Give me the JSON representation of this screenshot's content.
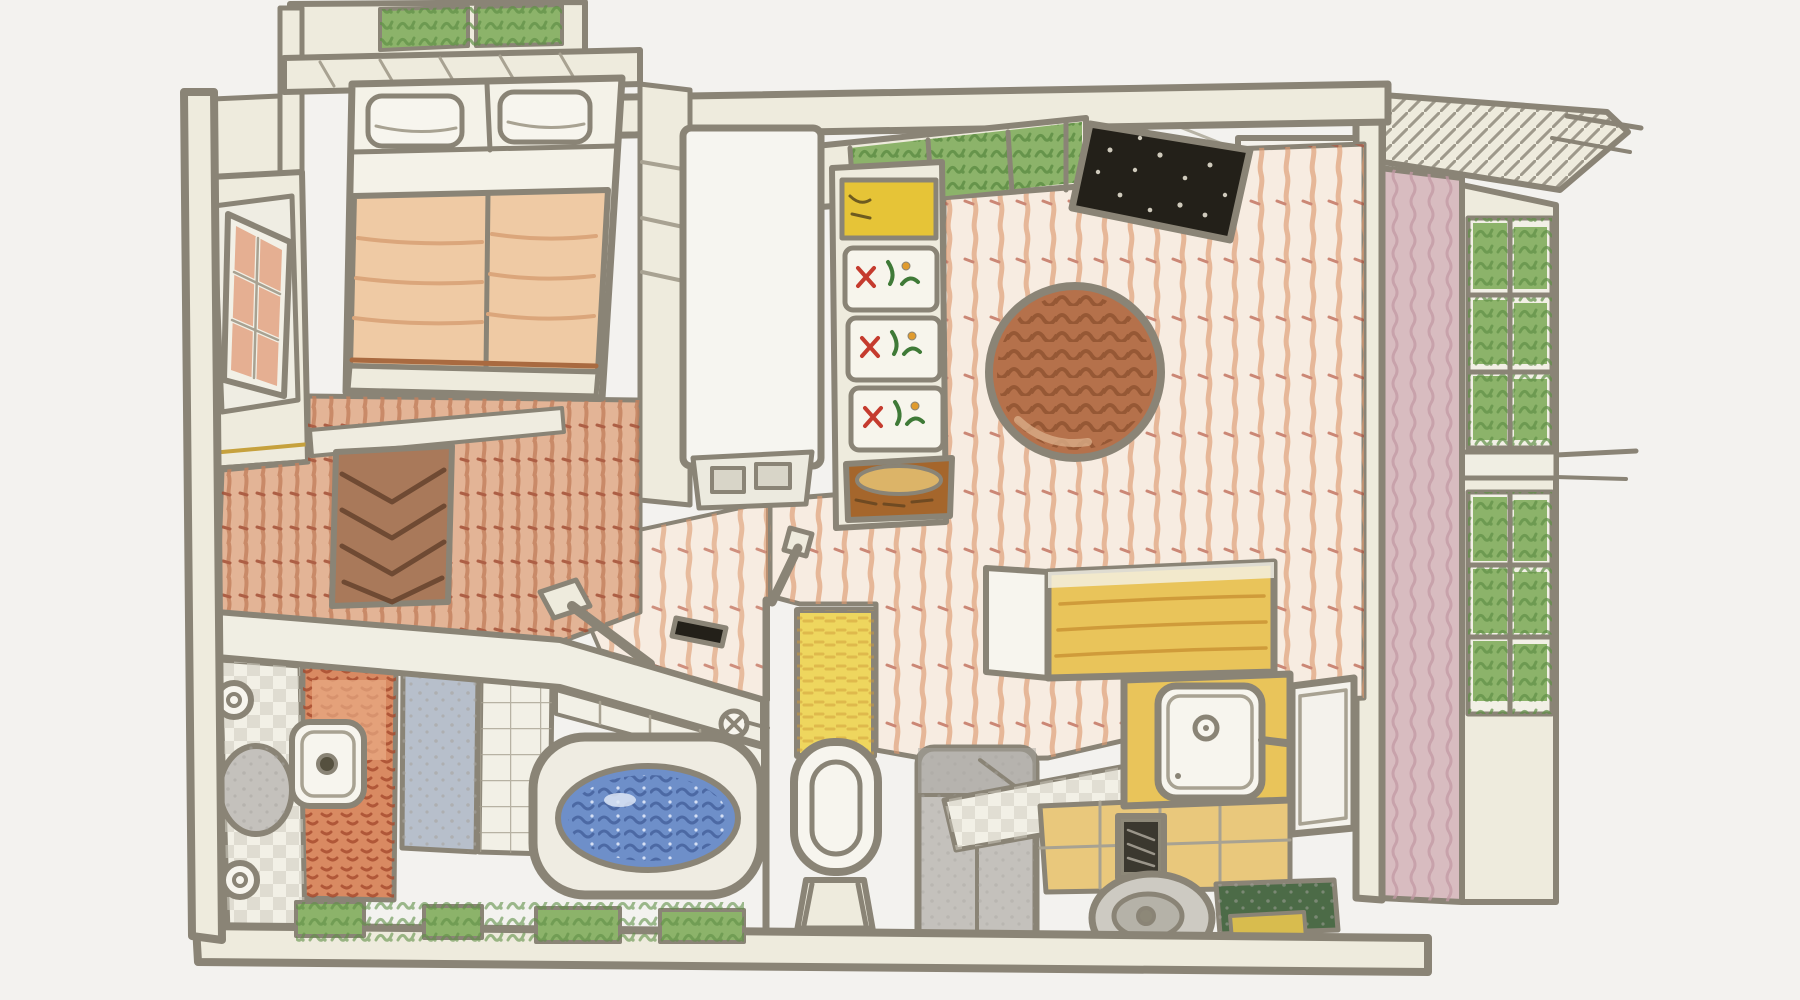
{
  "scene": {
    "type": "hand-drawn colored pencil sketch",
    "subject": "isometric cutaway floor plan of a small apartment",
    "rooms": [
      {
        "name": "bedroom",
        "objects": [
          "green-skylight",
          "headboard-shelf",
          "double-bed",
          "two-pillows",
          "peach-blanket",
          "open-window-peach-panes",
          "herringbone-dresser",
          "red-scribble-floor",
          "gold-trim-line"
        ]
      },
      {
        "name": "living-room",
        "objects": [
          "striped-pink-carpet",
          "round-brown-rug",
          "clerestory-green-windows",
          "black-speckled-panel",
          "flower-box-shelf",
          "yellow-storage-box",
          "woven-basket",
          "tall-white-cabinet-with-vent"
        ]
      },
      {
        "name": "bathroom",
        "objects": [
          "white-counter-ledge",
          "black-soap-dish",
          "shower-pipe",
          "bathtub",
          "blue-water",
          "faucet-knob",
          "terracotta-tile-wall",
          "blue-gray-wall",
          "white-tile-wall",
          "checkered-floor",
          "round-fixtures",
          "cistern-lid"
        ]
      },
      {
        "name": "toilet-nook",
        "objects": [
          "yellow-wall",
          "toilet",
          "step-stool",
          "diagonal-pipe"
        ]
      },
      {
        "name": "kitchen",
        "objects": [
          "gray-sofa",
          "floating-yellow-counter",
          "sink-counter",
          "white-sink-basin",
          "faucet",
          "checker-floor-strip",
          "yellow-tile-floor",
          "dark-floor-grate",
          "robot-vacuum",
          "green-door-mat",
          "window-panel"
        ]
      },
      {
        "name": "exterior-right",
        "objects": [
          "hatched-roof-overhang",
          "eave-lines",
          "corner-post",
          "ladder-style-window",
          "pink-textured-column",
          "plant-filled-windows",
          "protruding-ledge-lines"
        ]
      }
    ]
  },
  "palette": {
    "paper": "#f3f2ef",
    "pencil": "#8a8476",
    "pencil_light": "#a8a292",
    "wall_beige": "#eeebdd",
    "window_green": "#8cb36a",
    "window_green_dark": "#5f8f46",
    "pane_peach": "#e5af92",
    "blanket_peach": "#efcaa4",
    "blanket_fold": "#dba67b",
    "blanket_edge": "#a96a40",
    "sheet_white": "#f4f2e8",
    "floor_red": "#e3b496",
    "floor_red_stroke": "#c3805d",
    "floor_red_dark": "#a04a31",
    "carpet_base": "#f7ece1",
    "carpet_stripe": "#dd9a70",
    "carpet_red": "#b4513b",
    "herringbone": "#a9795a",
    "herringbone_dark": "#6f4a33",
    "rug_brown": "#b5714b",
    "rug_brown_dark": "#8e5230",
    "panel_black": "#232019",
    "panel_speck": "#cfcabc",
    "shelf_yellow": "#e6c437",
    "basket_brown": "#a5662c",
    "basket_tan": "#dcb468",
    "floral_red": "#c53b2e",
    "floral_orange": "#e09b2d",
    "floral_green": "#3f7a37",
    "column_pink": "#d8bcc0",
    "column_pink_dark": "#c29aa4",
    "tile_terracotta": "#d98a62",
    "tile_terracotta_dark": "#a64a2e",
    "wall_bluegray": "#b7bfcb",
    "tile_white": "#f2f0e6",
    "water_blue": "#6e8fc9",
    "water_blue_dark": "#46629e",
    "wall_yellow": "#eed65e",
    "counter_yellow": "#e9c45a",
    "counter_streak": "#cf9b3a",
    "kitchen_floor": "#e9c87c",
    "sofa_gray": "#c4c1bc",
    "sofa_gray_dark": "#a8a5a0",
    "fixture_white": "#f7f5ee",
    "checker_dark": "#cfccc0",
    "mat_green": "#4c6b47",
    "grate_dark": "#3b382f",
    "grate_frame": "#8d8878",
    "gold_line": "#c6a13d",
    "ledge_white": "#f0eee3"
  }
}
